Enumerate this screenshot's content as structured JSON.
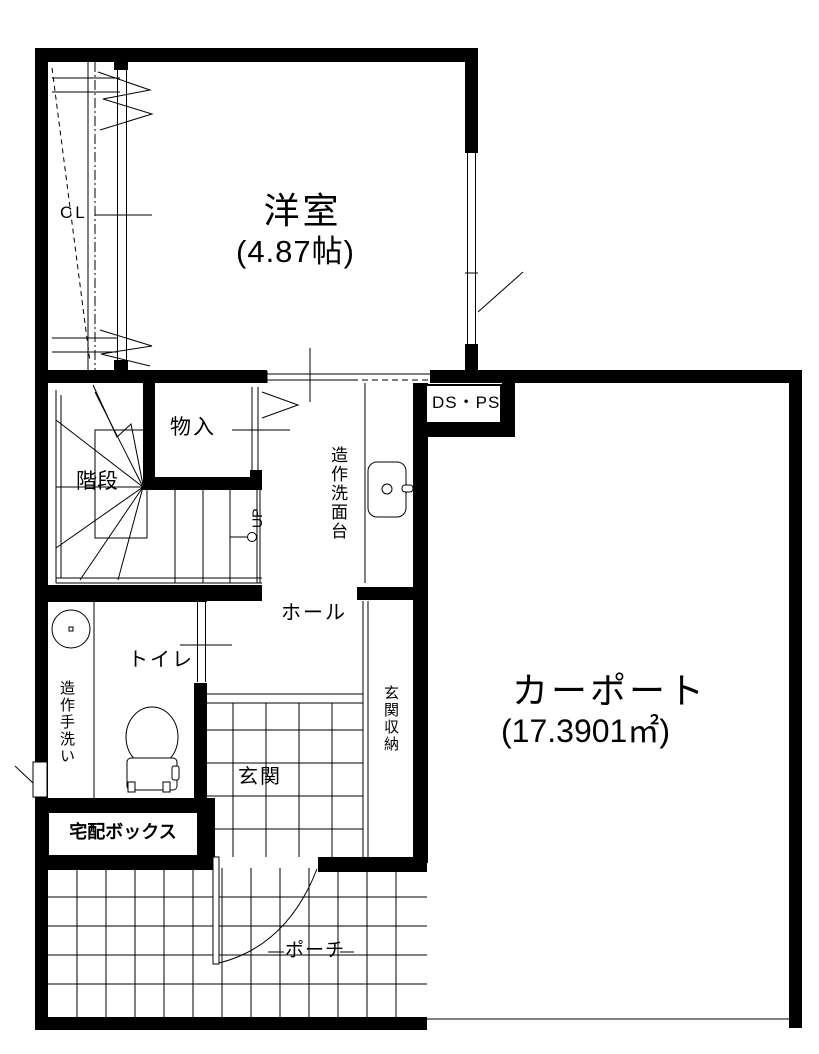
{
  "plan_title": "1F floor plan",
  "labels": {
    "closet": "CL",
    "western_room": "洋室",
    "western_room_size": "(4.87帖)",
    "storage": "物入",
    "stairs": "階段",
    "stairs_direction": "UP",
    "washstand": "造作洗面台",
    "ds_ps": "DS・PS",
    "hall": "ホール",
    "toilet": "トイレ",
    "hand_wash": "造作手洗い",
    "entrance_storage": "玄関収納",
    "entrance": "玄関",
    "delivery_box": "宅配ボックス",
    "porch": "ポーチ",
    "carport": "カーポート",
    "carport_size": "(17.3901㎡)"
  },
  "colors": {
    "wall": "#000000",
    "line": "#000000",
    "background": "#ffffff"
  }
}
